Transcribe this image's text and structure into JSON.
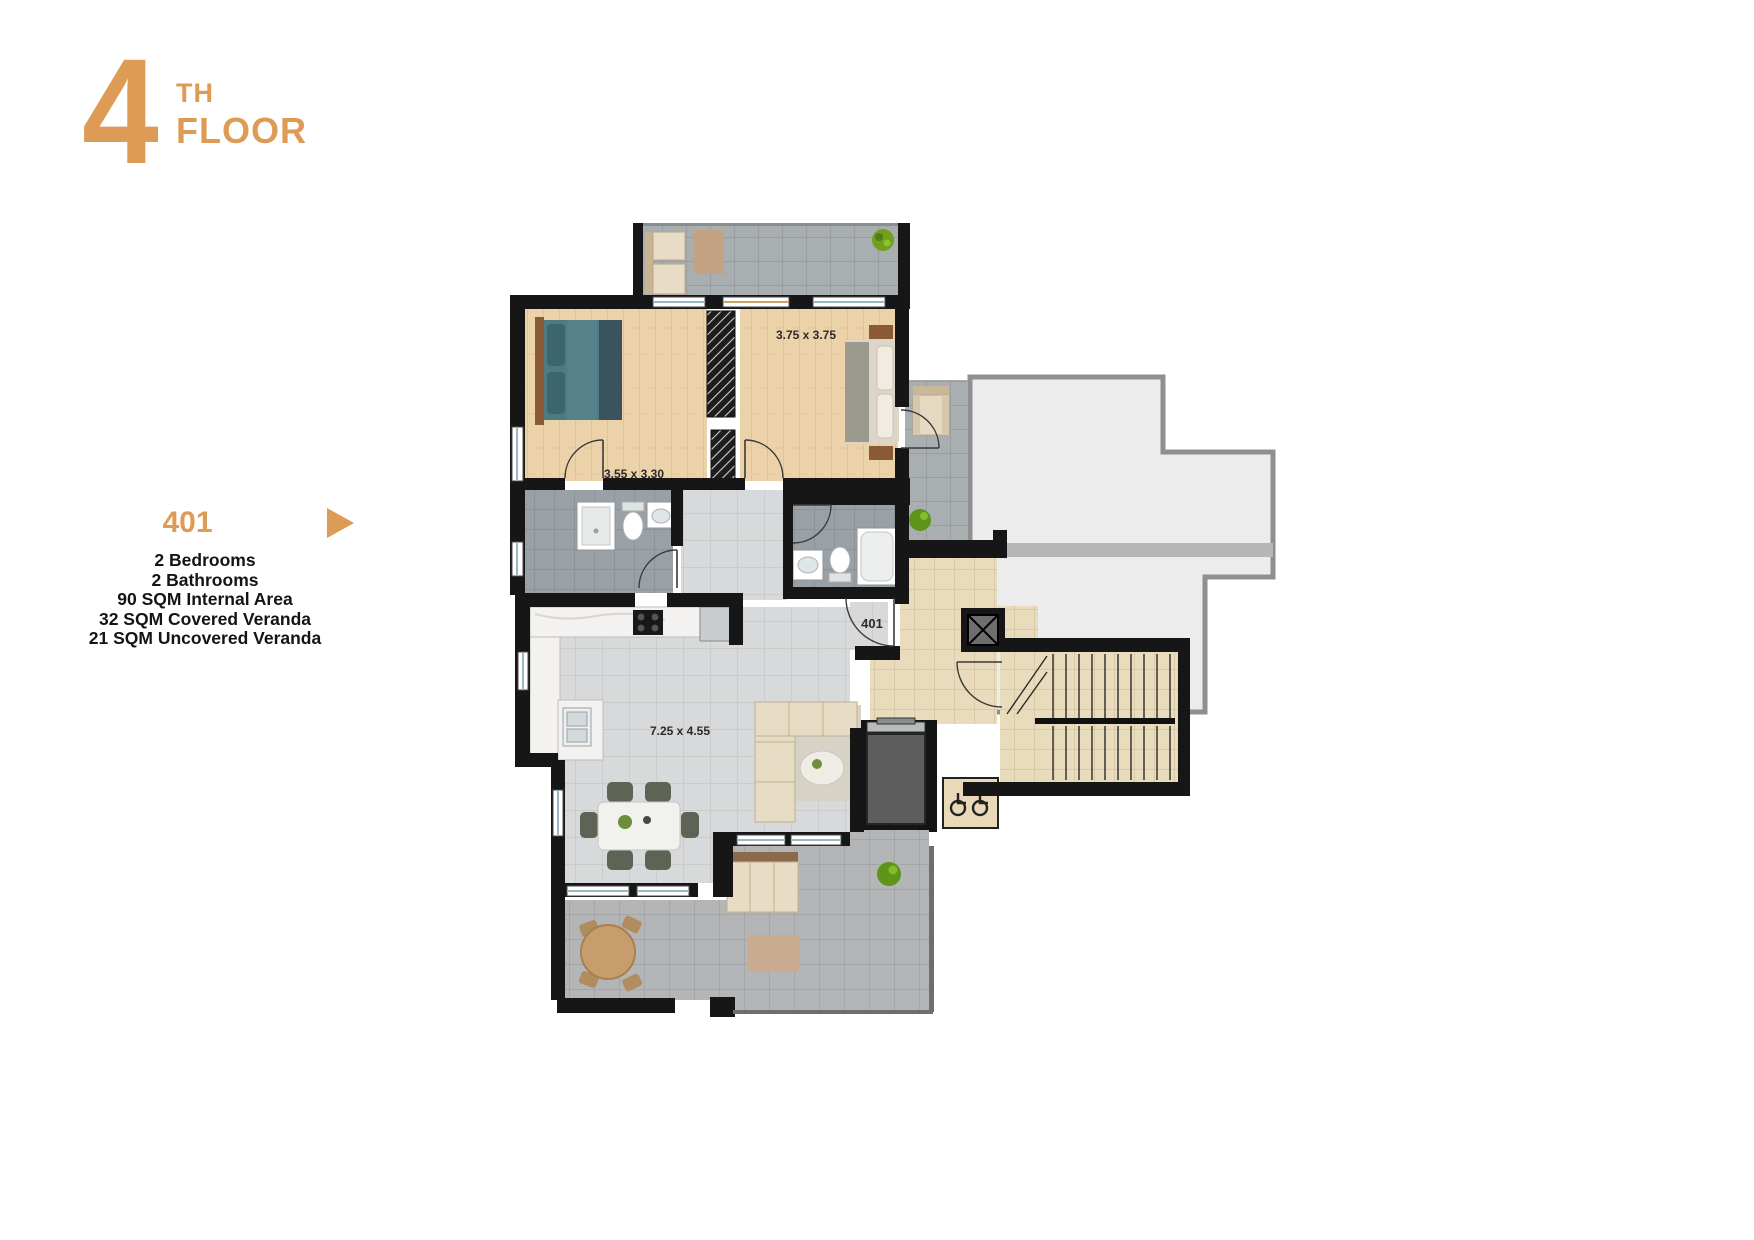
{
  "header": {
    "floor_number": "4",
    "ordinal_suffix": "TH",
    "floor_label": "FLOOR"
  },
  "unit_panel": {
    "unit_number": "401",
    "arrow_icon": "right-triangle",
    "features": [
      "2 Bedrooms",
      "2 Bathrooms",
      "90 SQM Internal Area",
      "32 SQM Covered Veranda",
      "21 SQM Uncovered Veranda"
    ]
  },
  "floor_plan": {
    "room_labels": [
      {
        "id": "bedroom-1",
        "dimension": "3.55 x 3.30"
      },
      {
        "id": "bedroom-2",
        "dimension": "3.75 x 3.75"
      },
      {
        "id": "living-room",
        "dimension": "7.25 x 4.55"
      }
    ],
    "entrance_label": "401"
  },
  "colors": {
    "accent": "#DD9B55",
    "wall": "#161616",
    "wood_floor": "#ECD2A9",
    "tile_gray": "#A9AEB1",
    "tile_bath": "#9AA1A6",
    "tile_light": "#D8D9DA",
    "tile_veranda": "#B3B5B6",
    "tile_beige": "#E9DCBD",
    "neighbor_fill": "#ECECEC",
    "bed_teal": "#4A7480"
  }
}
